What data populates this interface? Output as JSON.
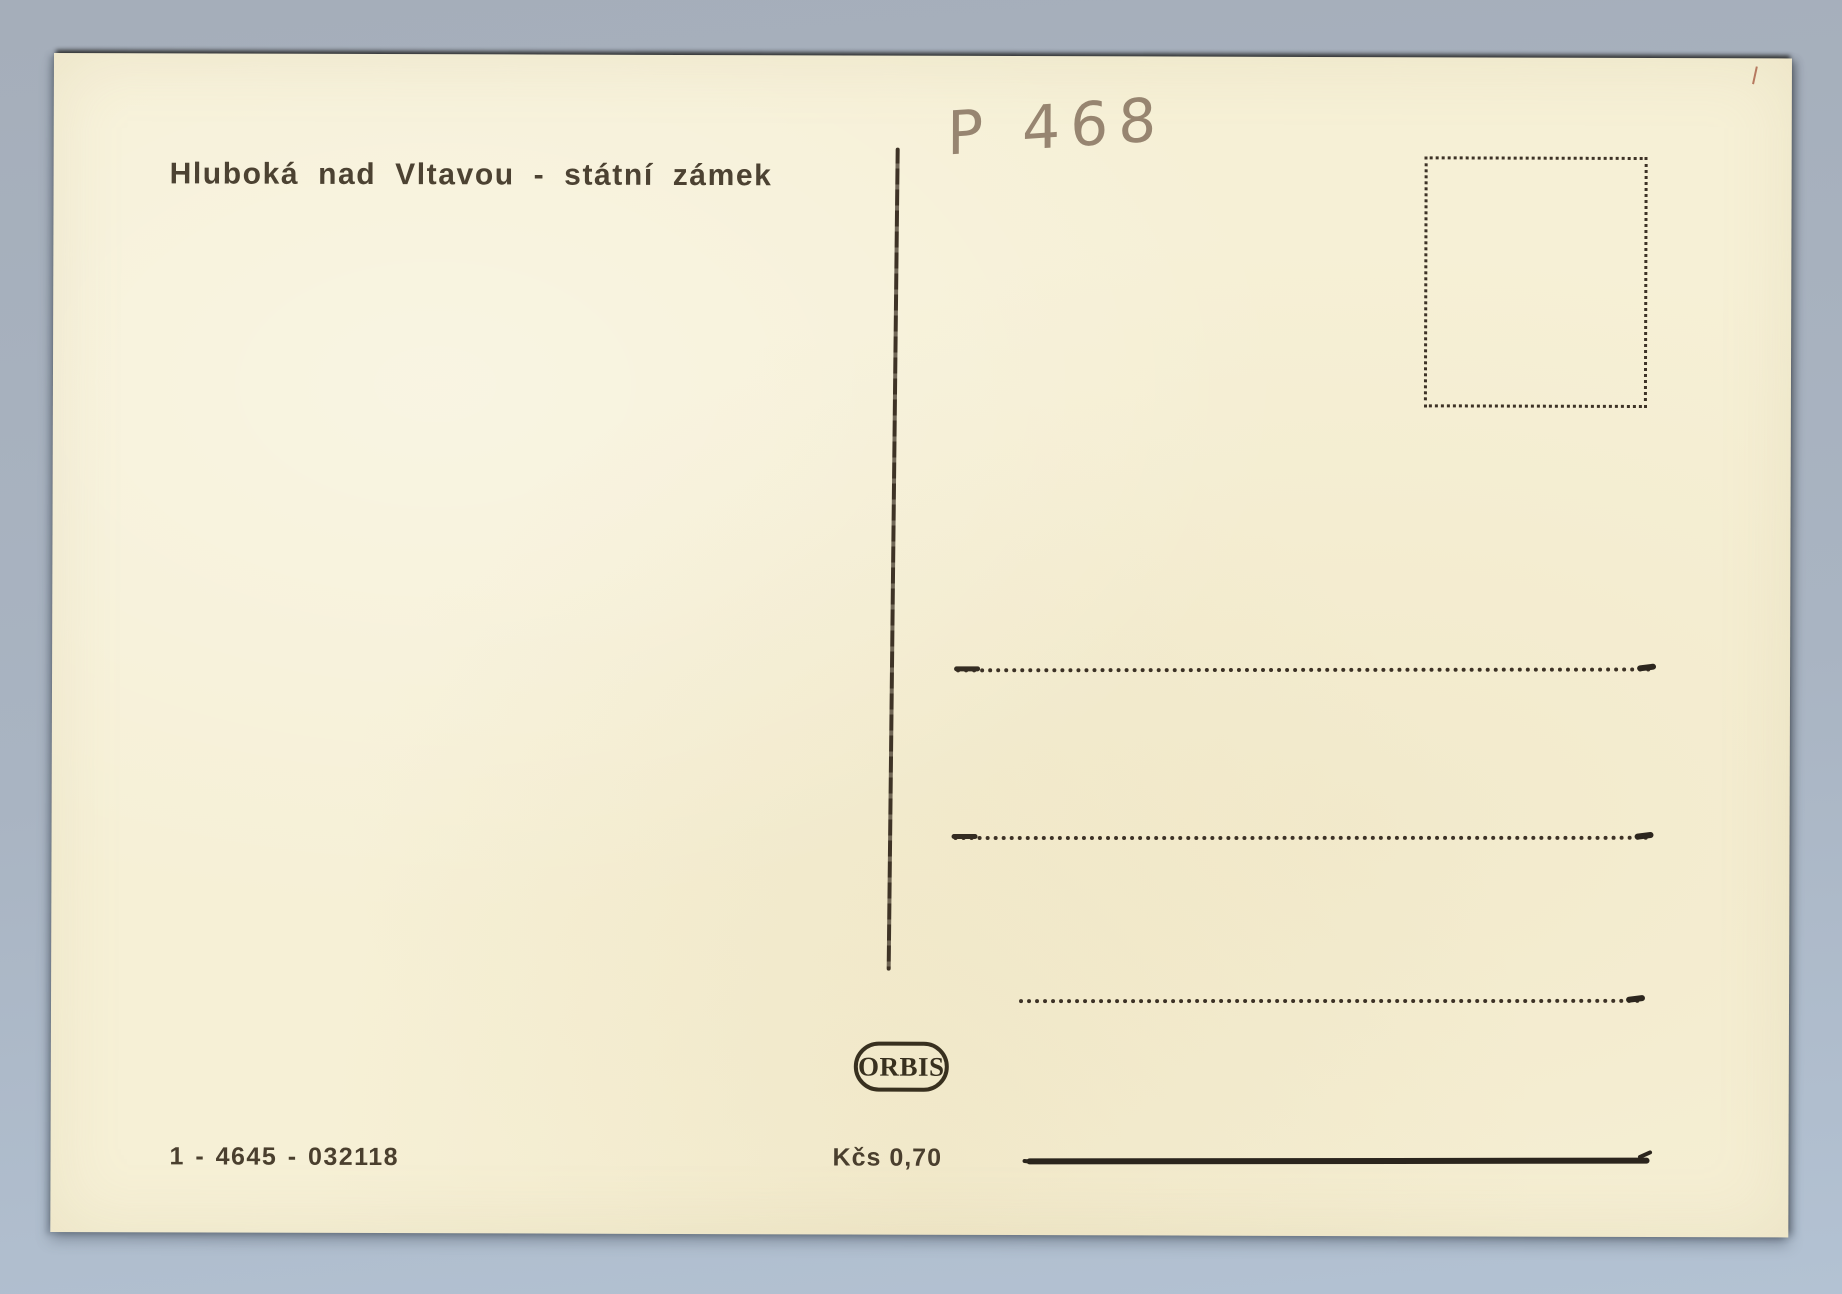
{
  "background": {
    "color": "#a9b4c2",
    "description_colors": {
      "paper": "#f6f0d6",
      "ink": "#3d3226",
      "pencil": "#8d7a66"
    }
  },
  "postcard": {
    "caption": "Hluboká nad Vltavou - státní zámek",
    "handwritten_note": "P 468",
    "publisher": {
      "logo_text": "ORBIS"
    },
    "print_number": "1 - 4645 - 032118",
    "price": "Kčs 0,70"
  }
}
